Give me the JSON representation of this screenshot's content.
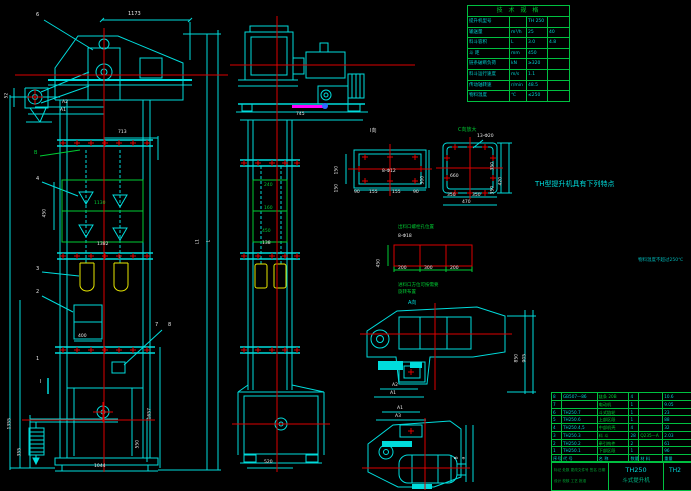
{
  "meta": {
    "drawing_type": "CAD assembly drawing",
    "product": "TH250 bucket elevator"
  },
  "colors": {
    "line": "#00dcdc",
    "centerline": "#dd0000",
    "aux_green": "#00cc33",
    "bucket_yellow": "#e8e800",
    "magenta": "#ff00ff",
    "blue_dot": "#2a6cff",
    "dim_white": "#e8e8e8",
    "table_grid": "#00c040",
    "text_cyan": "#00cfcf"
  },
  "left": {
    "d1173": "1173",
    "n6": "6",
    "d52": "52",
    "dA2": "A2",
    "dA1": "A1",
    "nB": "B",
    "n4": "4",
    "d713": "713",
    "d450": "450",
    "d1130": "1130",
    "d1382": "1382",
    "n3": "3",
    "n2": "2",
    "n1": "1",
    "n7": "7",
    "n8": "8",
    "nI": "I",
    "d400": "400",
    "dH": "H(提升高度)",
    "d1355": "1355",
    "d355": "355",
    "d1657": "1657",
    "d550": "550",
    "d1044": "1044",
    "dL": "L",
    "dL1": "L1"
  },
  "mid": {
    "d745": "745",
    "d240": "240",
    "d160": "160",
    "d450": "450",
    "d138": "138",
    "d520": "520"
  },
  "detail_i": {
    "label": "Ⅰ向",
    "holes": "8-Φ12",
    "l1": "150",
    "l2": "150",
    "r1": "300",
    "b1": "90",
    "b2": "155",
    "b3": "155",
    "b4": "90"
  },
  "detail_c": {
    "label": "C向放大",
    "holes": "13-Φ20",
    "inner": "660",
    "b1": "350",
    "b2": "350",
    "bt": "470",
    "r1": "350",
    "r2": "350",
    "rt": "420"
  },
  "outlet": {
    "title": "出料口螺栓孔位置",
    "holes": "8-Φ18",
    "left": "450",
    "b1": "200",
    "b2": "300",
    "b3": "200"
  },
  "aview": {
    "note1": "进料口方位可按需要",
    "note2": "旋转布置",
    "label": "A向",
    "u_r1": "850",
    "u_r2": "905",
    "u_b1": "A2",
    "u_b2": "A1",
    "l_t1": "A1",
    "l_t2": "A3",
    "l_r1": "B",
    "l_r2": "a"
  },
  "spec": {
    "title": "技 术 规 格",
    "rows": [
      {
        "l": "提升机型号",
        "u": "",
        "v1": "TH 250",
        "v2": ""
      },
      {
        "l": "输送量",
        "u": "m³/h",
        "v1": "25",
        "v2": "40"
      },
      {
        "l": "料斗容积",
        "u": "L",
        "v1": "3.0",
        "v2": "4.8"
      },
      {
        "l": "斗  距",
        "u": "mm",
        "v1": "450",
        "v2": ""
      },
      {
        "l": "链条破断负荷",
        "u": "kN",
        "v1": "≥320",
        "v2": ""
      },
      {
        "l": "料斗运行速度",
        "u": "m/s",
        "v1": "1.1",
        "v2": ""
      },
      {
        "l": "传动轴转速",
        "u": "r/min",
        "v1": "48.5",
        "v2": ""
      },
      {
        "l": "物料温度",
        "u": "℃",
        "v1": "≤250",
        "v2": ""
      }
    ]
  },
  "notes": {
    "title": "TH型提升机具有下列特点",
    "side": "物料温度不超过250℃",
    "lines": [
      "1.结构简单,运行平稳可靠,噪声小,密封性好,粉尘污染小,使用寿命长.",
      "2.输送能力大,提升高度高,采用流入式喂料,诱导式卸料,大容量料斗密集布置,物料提",
      "  升时几乎无回料和挖料现象,故无效功率小,驱动功率小.",
      "3.下部采用重锤自动张紧装置,张紧行程大,可补偿牵引链的伸长,一次安装调好后即可",
      "  长期使用,人工调节重锤,安全可靠易维护.",
      "4.牵引件采用高强度耐磨圆环链,与料斗连接的运转部件均采用滚动轴承,运转灵活,传",
      "  动效率高,易损件少,维修工作量小,使用费用低.出料口法兰尺寸与同规格的其它斗式",
      "  提升机相同,安装连接方便,可在室内或室外使用.",
      "5.提升范围广,对物料的种类,特性要求低,不但能提升一般粉状,粒状物料,也可提升磨",
      "  琢性较大的物料,密封性好,环境污染少.",
      "安装与使用须知:",
      "1.本提升机适用于输送堆积密度小于1.5t/m³的粉状,粒状,小块状的",
      "  无磨琢性,半磨琢性物料.",
      "2.安装时先固定下部区段,找正后灌浆,再安装中部机壳及上部区段.",
      "(1)机壳安装时应校正铅垂度,全高铅垂偏差不大于10mm,校正后与基础固定牢靠.",
      "(2)中部机壳分节长度不等,可按提升高度需要组合,接口处加密封垫.",
      "(3)整机安装完毕后应进行不少于2h的空载试运转,不得有卡链,跳链及料斗碰撞现象.",
      "(4)空载试车正常后方可进行负载试运转,轴承温升不得超过25℃,减速器温升不得超",
      "  过30℃,各密封处不得漏灰,确认正常后方可投入使用.",
      "",
      "(8)TH250(中间高度)H系列提升机出厂时随机供应装配图,基础图及使用说明书."
    ]
  },
  "bom": {
    "header": [
      "序号",
      "代  号",
      "名  称",
      "数量",
      "材  料",
      "重量"
    ],
    "rows": [
      [
        "8",
        "GB507—86",
        "链条 20B",
        "4",
        "",
        "10.6"
      ],
      [
        "7",
        "",
        "电动机",
        "1",
        "",
        "9.05"
      ],
      [
        "6",
        "TH250.7",
        "斗式链轮",
        "1",
        "",
        "23"
      ],
      [
        "5",
        "TH250.6",
        "上部区段",
        "1",
        "",
        "88"
      ],
      [
        "4",
        "TH250.4,5",
        "中部机壳",
        "4",
        "",
        "32"
      ],
      [
        "3",
        "TH250.3",
        "料  斗",
        "28",
        "Q235—A",
        "2.03"
      ],
      [
        "2",
        "TH250.2",
        "牵引构件",
        "2",
        "",
        "61"
      ],
      [
        "1",
        "TH250.1",
        "下部区段",
        "1",
        "",
        "96"
      ]
    ]
  },
  "tb": {
    "model": "TH250",
    "name": "斗式提升机",
    "drawing_no": "TH2",
    "sig1": "标记 处数 更改文件号 签名 日期",
    "sig2": "设计  校核  工艺  批准"
  }
}
